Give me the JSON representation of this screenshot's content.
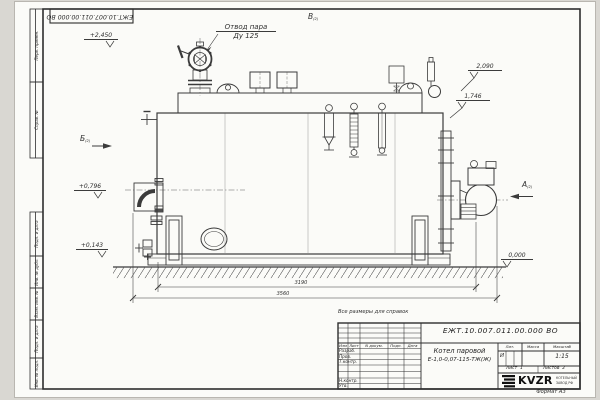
{
  "drawing": {
    "note_for_reference": "Все размеры для справок",
    "format_label": "Формат А3",
    "labels": {
      "steam_outlet_line1": "Отвод пара",
      "steam_outlet_line2": "Ду 125"
    },
    "views": {
      "a": "А",
      "b": "Б",
      "v": "В",
      "sheet_ref": "(2)"
    },
    "elevations": {
      "top": "+2,450",
      "upper_right": "2,090",
      "drum": "1,746",
      "feed": "+0,796",
      "lower": "+0,143",
      "ground": "0,000"
    },
    "dimensions": {
      "boiler_length": "3190",
      "overall_length": "3560"
    },
    "frame_stamps": {
      "top_left_number": "ЕЖТ.10.007.011.00.000 ВО",
      "left_column": [
        "Перв. примен.",
        "Справ. №",
        "Подп. и дата",
        "Инв. № дубл.",
        "Взам. инв. №",
        "Подп. и дата",
        "Инв. № подл."
      ]
    }
  },
  "title_block": {
    "doc_number": "ЕЖТ.10.007.011.00.000  ВО",
    "product_line1": "Котел паровой",
    "product_line2": "Е-1,0-0,07-115-ТЖ(Ж)",
    "col_headers": {
      "izm": "Изм",
      "list": "Лист",
      "doc": "N докум.",
      "podp": "Подп.",
      "data": "Дата"
    },
    "rows": {
      "razrab": "Разраб.",
      "prov": "Пров.",
      "tkontr": "Т.контр.",
      "nkontr": "Н.контр.",
      "utv": "Утв."
    },
    "lit_header": "Лит.",
    "mass_header": "Масса",
    "scale_header": "Масштаб",
    "lit_value": "И",
    "scale_value": "1:15",
    "sheet_label": "Лист",
    "sheet_value": "1",
    "sheets_label": "Листов",
    "sheets_value": "2",
    "company": {
      "name": "KVZR",
      "tagline1": "КОТЕЛЬНЫЙ",
      "tagline2": "ЗАВОД РФ"
    }
  }
}
